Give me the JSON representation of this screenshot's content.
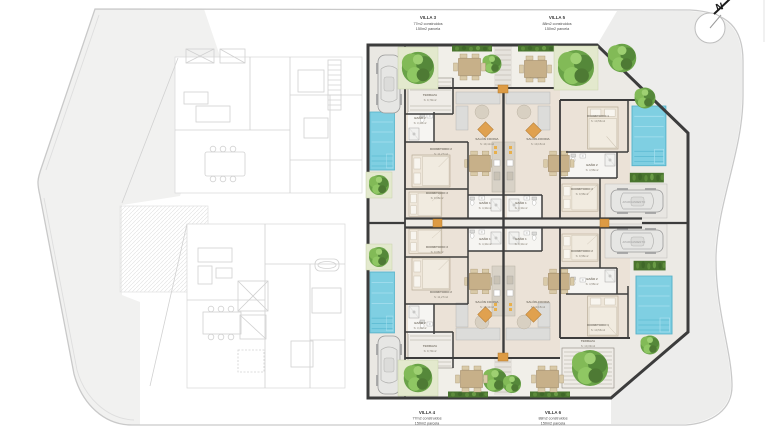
{
  "plan": {
    "compass_label": "N",
    "villas": {
      "v3": {
        "name": "VILLA 3",
        "built": "77m2 construidos",
        "plot": "150m2 parcela"
      },
      "v5": {
        "name": "VILLA 5",
        "built": "88m2 construidos",
        "plot": "150m2 parcela"
      },
      "v4": {
        "name": "VILLA 4",
        "built": "77m2 construidos",
        "plot": "150m2 parcela"
      },
      "v6": {
        "name": "VILLA 6",
        "built": "88m2 construidos",
        "plot": "150m2 parcela"
      }
    },
    "rooms": {
      "v3": {
        "terraza": {
          "n": "TERRAZA",
          "a": "S: 9,79m2"
        },
        "bano2": {
          "n": "BAÑO 2",
          "a": "S: 3,43m2"
        },
        "dorm2": {
          "n": "DORMITORIO 2",
          "a": "S: 11,27m2"
        },
        "dorm3": {
          "n": "DORMITORIO 3",
          "a": "S: 9,68m2"
        },
        "bano1": {
          "n": "BAÑO 1",
          "a": "S: 4,34m2"
        },
        "salon": {
          "n": "SALÓN COCINA",
          "a": "S: 19,11m2"
        }
      },
      "v4": {
        "terraza": {
          "n": "TERRAZA",
          "a": "S: 9,79m2"
        },
        "bano2": {
          "n": "BAÑO 2",
          "a": "S: 3,43m2"
        },
        "dorm2": {
          "n": "DORMITORIO 2",
          "a": "S: 11,27m2"
        },
        "dorm3": {
          "n": "DORMITORIO 3",
          "a": "S: 9,68m2"
        },
        "bano1": {
          "n": "BAÑO 1",
          "a": "S: 4,34m2"
        },
        "salon": {
          "n": "SALÓN COCINA",
          "a": "S: 19,11m2"
        }
      },
      "v5": {
        "terraza": {
          "n": "TERRAZA",
          "a": "S: 9,68m2"
        },
        "salon": {
          "n": "SALÓN-COCINA",
          "a": "S: 19,15m2"
        },
        "dorm1": {
          "n": "DORMITORIO 1",
          "a": "S: 10,56m2"
        },
        "bano2": {
          "n": "BAÑO 2",
          "a": "S: 4,58m2"
        },
        "dorm2": {
          "n": "DORMITORIO 2",
          "a": "S: 9,58m2"
        },
        "bano1": {
          "n": "BAÑO 1",
          "a": "S: 4,34m2"
        },
        "parking": "APARCAMIENTO"
      },
      "v6": {
        "terraza": {
          "n": "TERRAZA",
          "a": "S: 10,33m2"
        },
        "salon": {
          "n": "SALÓN-COCINA",
          "a": "S: 19,15m2"
        },
        "dorm1": {
          "n": "DORMITORIO 1",
          "a": "S: 10,56m2"
        },
        "bano2": {
          "n": "BAÑO 2",
          "a": "S: 4,58m2"
        },
        "dorm2": {
          "n": "DORMITORIO 2",
          "a": "S: 9,58m2"
        },
        "bano1": {
          "n": "BAÑO 1",
          "a": "S: 4,34m2"
        },
        "parking": "APARCAMIENTO"
      }
    },
    "colors": {
      "pool": "#7fcfe2",
      "wall": "#3c3c3c",
      "accent_orange": "#dd9b44",
      "tree_green": "#5f9440",
      "floor_beige": "#ebe2d7",
      "site_line": "#c9c9c9"
    }
  }
}
